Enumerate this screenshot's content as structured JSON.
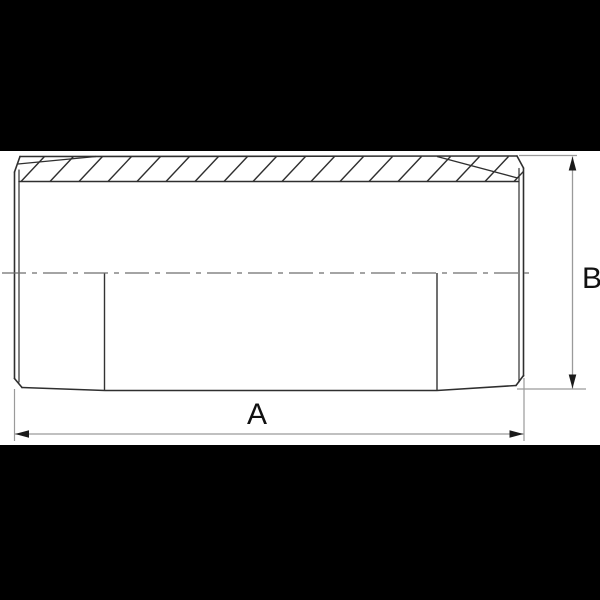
{
  "canvas": {
    "background_color": "#000000",
    "paper_color": "#ffffff"
  },
  "drawing": {
    "description_name": "threaded-pipe-nipple-technical-drawing",
    "line_color": "#2f2f2f",
    "dimension_line_color": "#9a9a9a",
    "centerline_color": "#6e6e6e",
    "arrow_color": "#1a1a1a",
    "label_color": "#111111",
    "labels": {
      "length": "A",
      "outer_diameter": "B"
    }
  }
}
